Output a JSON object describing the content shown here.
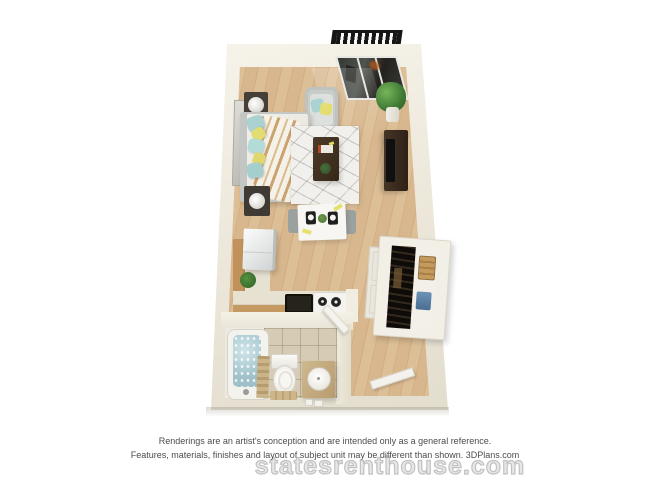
{
  "page": {
    "background_color": "#ffffff"
  },
  "floorplan": {
    "title": "3D studio apartment floor plan rendering",
    "rooms": [
      "balcony",
      "living-sleeping-area",
      "kitchen",
      "bathroom",
      "entry"
    ],
    "furniture": [
      "balcony-railing",
      "balcony-glass-door",
      "potted-plant",
      "wall-mirror",
      "armchair",
      "bed",
      "nightstand-lamp-top",
      "nightstand-lamp-bottom",
      "area-rug",
      "coffee-table",
      "tv-console",
      "dining-table",
      "dining-chairs",
      "refrigerator",
      "kitchen-counter",
      "kitchen-sink",
      "stove",
      "counter-plant",
      "wardrobe-closet",
      "closet-door-panel",
      "bathtub",
      "bath-mat",
      "toilet",
      "bathroom-vanity-sink",
      "bathroom-door",
      "entry-door"
    ],
    "colors": {
      "wall": "#ece7da",
      "floor_wood": "#d6b58c",
      "bathroom_tile": "#d6ccb6",
      "tub_water": "#a3c2cb",
      "pillow_teal": "#aed6d4",
      "pillow_yellow": "#e5de74",
      "counter_wood": "#c59a62",
      "dark_furniture": "#3a2b20",
      "railing": "#1a1a1a"
    }
  },
  "footer": {
    "disclaimer_line1": "Renderings are an artist's conception and are intended only as a general reference.",
    "disclaimer_line2": "Features, materials, finishes and layout of subject unit may be different than shown. 3DPlans.com",
    "watermark": "statesrenthouse.com"
  }
}
